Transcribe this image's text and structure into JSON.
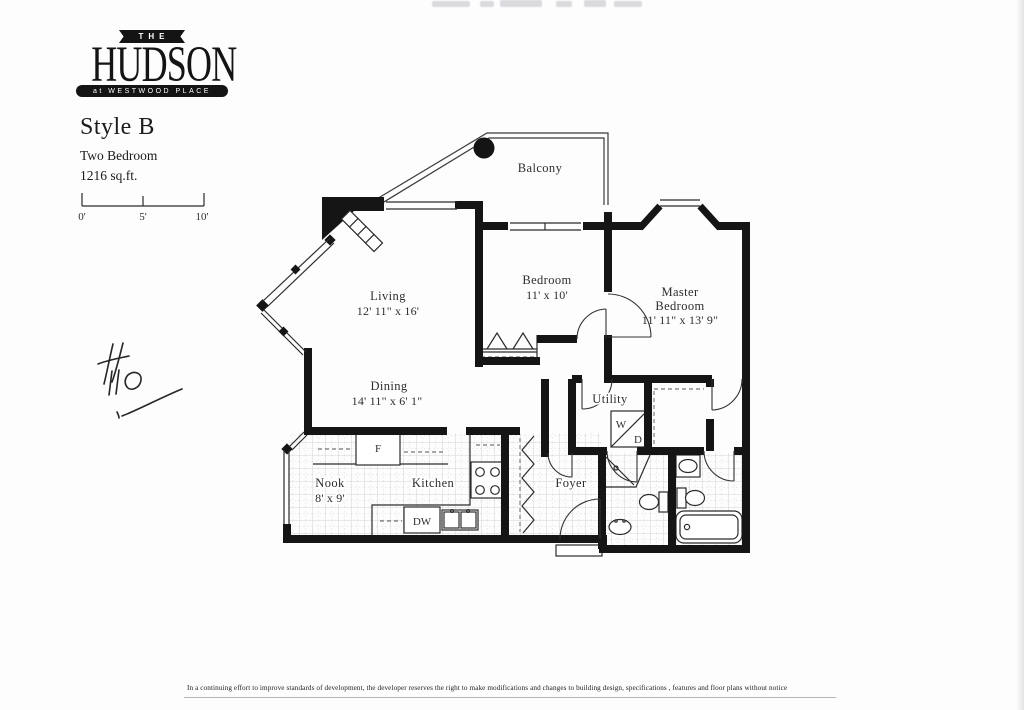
{
  "logo": {
    "the": "THE",
    "name": "HUDSON",
    "tagline": "at WESTWOOD PLACE"
  },
  "info": {
    "style": "Style B",
    "type": "Two Bedroom",
    "area": "1216 sq.ft."
  },
  "scale_bar": {
    "t0": "0'",
    "t5": "5'",
    "t10": "10'"
  },
  "rooms": {
    "balcony": {
      "name": "Balcony"
    },
    "living": {
      "name": "Living",
      "dims": "12' 11\" x 16'"
    },
    "dining": {
      "name": "Dining",
      "dims": "14' 11\" x 6' 1\""
    },
    "bedroom": {
      "name": "Bedroom",
      "dims": "11' x 10'"
    },
    "master": {
      "name1": "Master",
      "name2": "Bedroom",
      "dims": "11' 11\" x 13' 9\""
    },
    "utility": {
      "name": "Utility"
    },
    "nook": {
      "name": "Nook",
      "dims": "8' x 9'"
    },
    "kitchen": {
      "name": "Kitchen"
    },
    "foyer": {
      "name": "Foyer"
    }
  },
  "appliances": {
    "fridge": "F",
    "dishwasher": "DW",
    "washer": "W",
    "dryer": "D"
  },
  "annotation": {
    "handwritten": "#110"
  },
  "footer": {
    "disclaimer": "In a continuing effort to improve standards of development, the developer reserves the right to make modifications and changes to building design, specifications , features and floor plans without notice"
  },
  "colors": {
    "ink": "#1a1a1a",
    "paper": "#fdfdfd"
  }
}
